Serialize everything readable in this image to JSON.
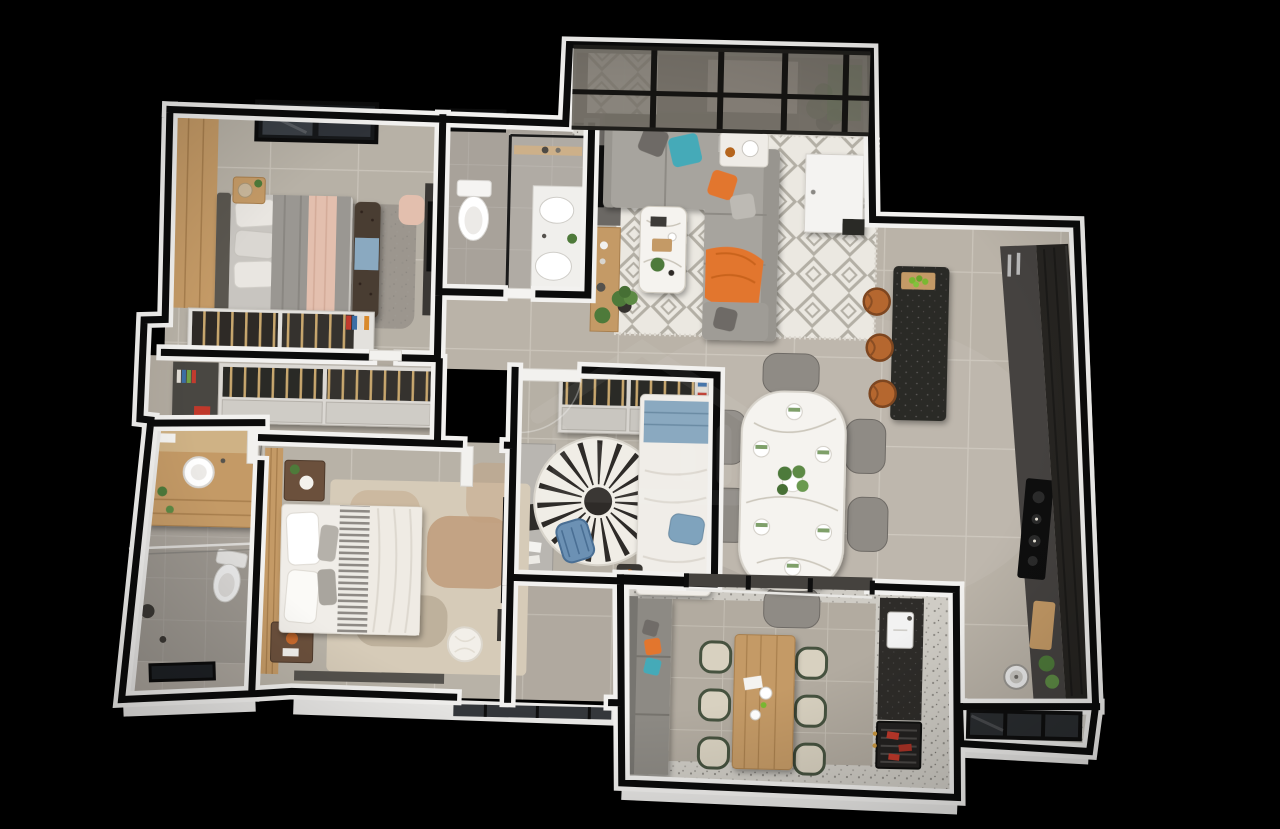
{
  "scene": {
    "kind": "3d-apartment-floor-plan-render",
    "view": "top-down dollhouse",
    "background": "black",
    "watermark_icon": "house-logo-watermark"
  },
  "colors": {
    "bg": "#000000",
    "wallFace": "#f2f1ef",
    "wallCore": "#0b0b0b",
    "floorMain": "#bab3a8",
    "floorDim": "#b2aba0",
    "floorBath": "#a8a29a",
    "wood": "#c49a66",
    "woodDark": "#a87f4e",
    "woodDeep": "#6b503c",
    "cabinetDark": "#2c2a27",
    "cabinetMid": "#454240",
    "sofa": "#a7a49e",
    "sofaDark": "#98958f",
    "teal": "#45aab8",
    "orange": "#e2762d",
    "rugBase": "#ebe8e1",
    "rugLine": "#b3afa5",
    "shag": "#9c968e",
    "bedWhite": "#f0ede8",
    "pink": "#e3bfae",
    "blue": "#8aa9c0",
    "blueChair": "#6c91b4",
    "marble": "#f5f3ef",
    "terrazzo": "#cfccc5",
    "wicker": "#d8d1c0",
    "wickerFrame": "#46523f",
    "plant": "#4e7a3a",
    "apple": "#7ab833",
    "meat": "#c0392b",
    "stoolOrange": "#b5672f",
    "glassDark": "#45423e",
    "glassWall": "#6f6a62"
  },
  "rooms": [
    {
      "id": "bedroom-1",
      "name": "Bedroom 1",
      "furniture": [
        "double-bed",
        "wood-accent-wall",
        "window",
        "nightstand",
        "table-lamp",
        "tufted-bench",
        "shag-rug",
        "pink-pouf",
        "tv-cabinet",
        "wardrobe"
      ]
    },
    {
      "id": "social-bathroom",
      "name": "Social Bathroom",
      "furniture": [
        "toilet",
        "glass-shower",
        "vanity-sinks",
        "window",
        "door"
      ]
    },
    {
      "id": "living-room",
      "name": "Living Room",
      "furniture": [
        "glass-curtain-wall",
        "sectional-sofa",
        "coffee-table",
        "side-table",
        "geometric-rug",
        "tv-panel",
        "wood-sideboard",
        "floor-plant",
        "entry-door"
      ]
    },
    {
      "id": "kitchen",
      "name": "Kitchen",
      "furniture": [
        "island-breakfast-bar",
        "bar-stools",
        "fruit-bowl",
        "tall-dark-cabinets",
        "counter-run",
        "cooktop",
        "cutting-board",
        "washer",
        "plants"
      ]
    },
    {
      "id": "dining-area",
      "name": "Dining Area",
      "furniture": [
        "marble-dining-table",
        "dining-chairs",
        "place-settings",
        "green-centerpiece"
      ]
    },
    {
      "id": "bedroom-2",
      "name": "Bedroom 2 / Office",
      "furniture": [
        "single-bed",
        "radial-rug",
        "desk",
        "blue-chair",
        "laptop",
        "wall-closet-shelves",
        "tv",
        "door"
      ]
    },
    {
      "id": "closet-hall",
      "name": "Walk-through Closet",
      "furniture": [
        "wardrobe-top",
        "wardrobe-bottom",
        "wood-hangers",
        "books",
        "red-box"
      ]
    },
    {
      "id": "master-bedroom",
      "name": "Master Bedroom",
      "furniture": [
        "double-bed",
        "striped-runner",
        "wood-headboard-wall",
        "nightstands",
        "area-rug",
        "pouf",
        "wall-tv",
        "glass-door",
        "low-bench"
      ]
    },
    {
      "id": "master-bathroom",
      "name": "Master Bathroom",
      "furniture": [
        "wood-vanity",
        "vessel-sink",
        "toilet",
        "glass-shower",
        "window",
        "door"
      ]
    },
    {
      "id": "balcony",
      "name": "Balcony / Terrace",
      "furniture": [
        "bench-sofa",
        "wood-outdoor-table",
        "wicker-chairs",
        "counter-with-sink",
        "barbecue-grill",
        "sliding-glass-doors"
      ]
    }
  ],
  "counts": {
    "dining_chairs": 6,
    "bar_stools": 3,
    "balcony_chairs": 6
  }
}
